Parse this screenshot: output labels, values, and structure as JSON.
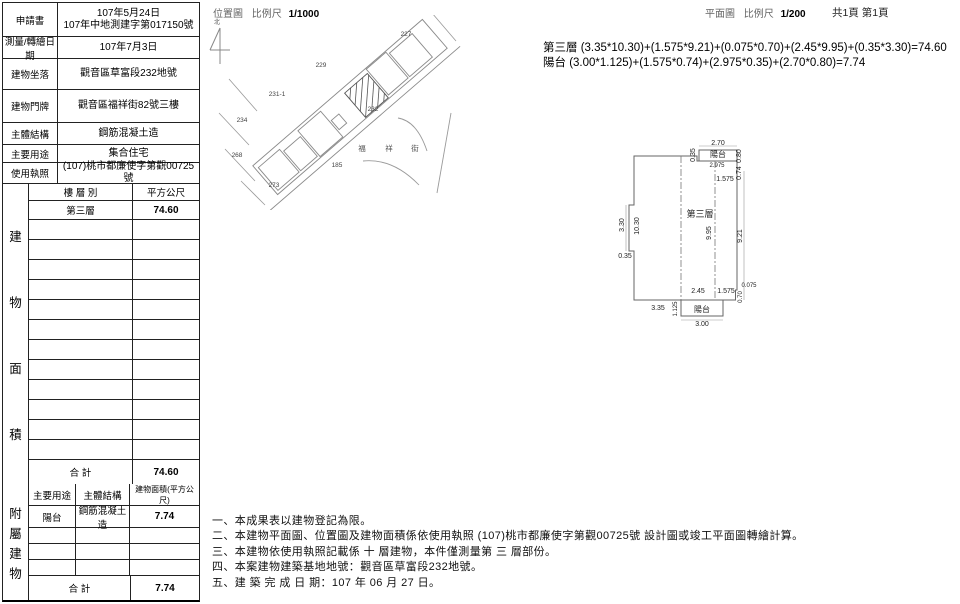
{
  "header": {
    "location_map": "位置圖",
    "scale_label1": "比例尺",
    "location_scale": "1/1000",
    "floor_plan": "平面圖",
    "scale_label2": "比例尺",
    "floor_scale": "1/200",
    "pages": "共1頁 第1頁",
    "north": "北"
  },
  "info": {
    "rows": [
      {
        "label": "申請書",
        "value1": "107年5月24日",
        "value2": "107年中地測建字第017150號"
      },
      {
        "label": "測量/轉繪日期",
        "value1": "107年7月3日"
      },
      {
        "label": "建物坐落",
        "value1": "觀音區草富段232地號"
      },
      {
        "label": "建物門牌",
        "value1": "觀音區福祥街82號三樓"
      },
      {
        "label": "主體結構",
        "value1": "鋼筋混凝土造"
      },
      {
        "label": "主要用途",
        "value1": "集合住宅"
      },
      {
        "label": "使用執照",
        "value1": "(107)桃市都廉使字第觀00725號"
      }
    ]
  },
  "building_area": {
    "side_chars": [
      "建",
      "物",
      "面",
      "積"
    ],
    "col_floor": "樓 層 別",
    "col_area": "平方公尺",
    "floor1": "第三層",
    "area1": "74.60",
    "total_label": "合  計",
    "total": "74.60"
  },
  "annex": {
    "side_chars": [
      "附",
      "屬",
      "建",
      "物"
    ],
    "col_use": "主要用途",
    "col_structure": "主體結構",
    "col_area": "建物面積(平方公尺)",
    "use1": "陽台",
    "structure1": "鋼筋混凝土造",
    "area1": "7.74",
    "total_label": "合  計",
    "total": "7.74"
  },
  "formulas": {
    "line1": "第三層 (3.35*10.30)+(1.575*9.21)+(0.075*0.70)+(2.45*9.95)+(0.35*3.30)=74.60",
    "line2": "陽台 (3.00*1.125)+(1.575*0.74)+(2.975*0.35)+(2.70*0.80)=7.74"
  },
  "map": {
    "parcels": {
      "p227": "227",
      "p229": "229",
      "p231_1": "231-1",
      "p234": "234",
      "p268": "268",
      "p273": "273",
      "p232": "232",
      "p185": "185"
    },
    "street_chars": [
      "福",
      "祥",
      "街"
    ]
  },
  "plan": {
    "room": "第三層",
    "balcony_top": "陽台",
    "balcony_bottom": "陽台",
    "dims": {
      "d270": "2.70",
      "d035a": "0.35",
      "d080": "0.80",
      "d2975": "2.975",
      "d074": "0.74",
      "d1575a": "1.575",
      "d330": "3.30",
      "d1030": "10.30",
      "d035b": "0.35",
      "d995": "9.95",
      "d921": "9.21",
      "d0075": "0.075",
      "d070": "0.70",
      "d245": "2.45",
      "d1575b": "1.575",
      "d335": "3.35",
      "d1125": "1.125",
      "d300": "3.00"
    }
  },
  "notes": {
    "n1": "一、本成果表以建物登記為限。",
    "n2": "二、本建物平面圖、位置圖及建物面積係依使用執照 (107)桃市都廉使字第觀00725號 設計圖或竣工平面圖轉繪計算。",
    "n3": "三、本建物依使用執照記載係 十 層建物，本件僅測量第 三 層部份。",
    "n4": "四、本案建物建築基地地號：觀音區草富段232地號。",
    "n5": "五、建 築 完 成 日 期：107 年 06 月 27 日。"
  }
}
